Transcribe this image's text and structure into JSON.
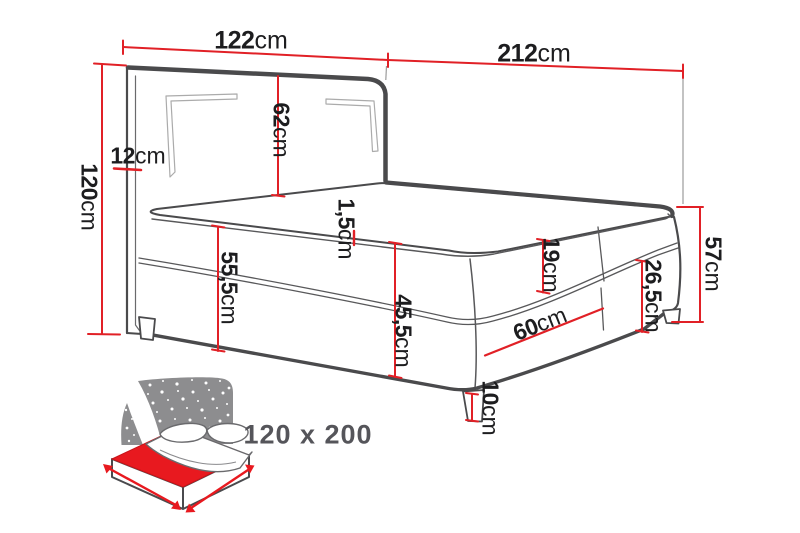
{
  "diagram": {
    "type": "bed-dimension-drawing",
    "unit": "cm",
    "dimensions": {
      "headboard_width": {
        "num": "122",
        "unit": "cm"
      },
      "bed_length": {
        "num": "212",
        "unit": "cm"
      },
      "headboard_height": {
        "num": "120",
        "unit": "cm"
      },
      "headboard_depth": {
        "num": "12",
        "unit": "cm"
      },
      "headboard_above_mattress": {
        "num": "62",
        "unit": "cm"
      },
      "floor_to_mattress_top": {
        "num": "55,5",
        "unit": "cm"
      },
      "piping_height": {
        "num": "1,5",
        "unit": "cm"
      },
      "body_height": {
        "num": "45,5",
        "unit": "cm"
      },
      "mattress_height": {
        "num": "19",
        "unit": "cm"
      },
      "half_foot_width": {
        "num": "60",
        "unit": "cm"
      },
      "base_height": {
        "num": "26,5",
        "unit": "cm"
      },
      "foot_corner_height": {
        "num": "57",
        "unit": "cm"
      },
      "leg_height": {
        "num": "10",
        "unit": "cm"
      }
    },
    "colors": {
      "dimension_red": "#e12026",
      "line_dark": "#4a4a4c",
      "line_thin": "#58585a",
      "groove_gray": "#ababab",
      "icon_gray": "#8d8d8f",
      "icon_red": "#e8191f",
      "label_text": "#1d1d1f",
      "caption_text": "#55555a"
    }
  },
  "icon_caption": {
    "size_label": "120 x 200"
  }
}
